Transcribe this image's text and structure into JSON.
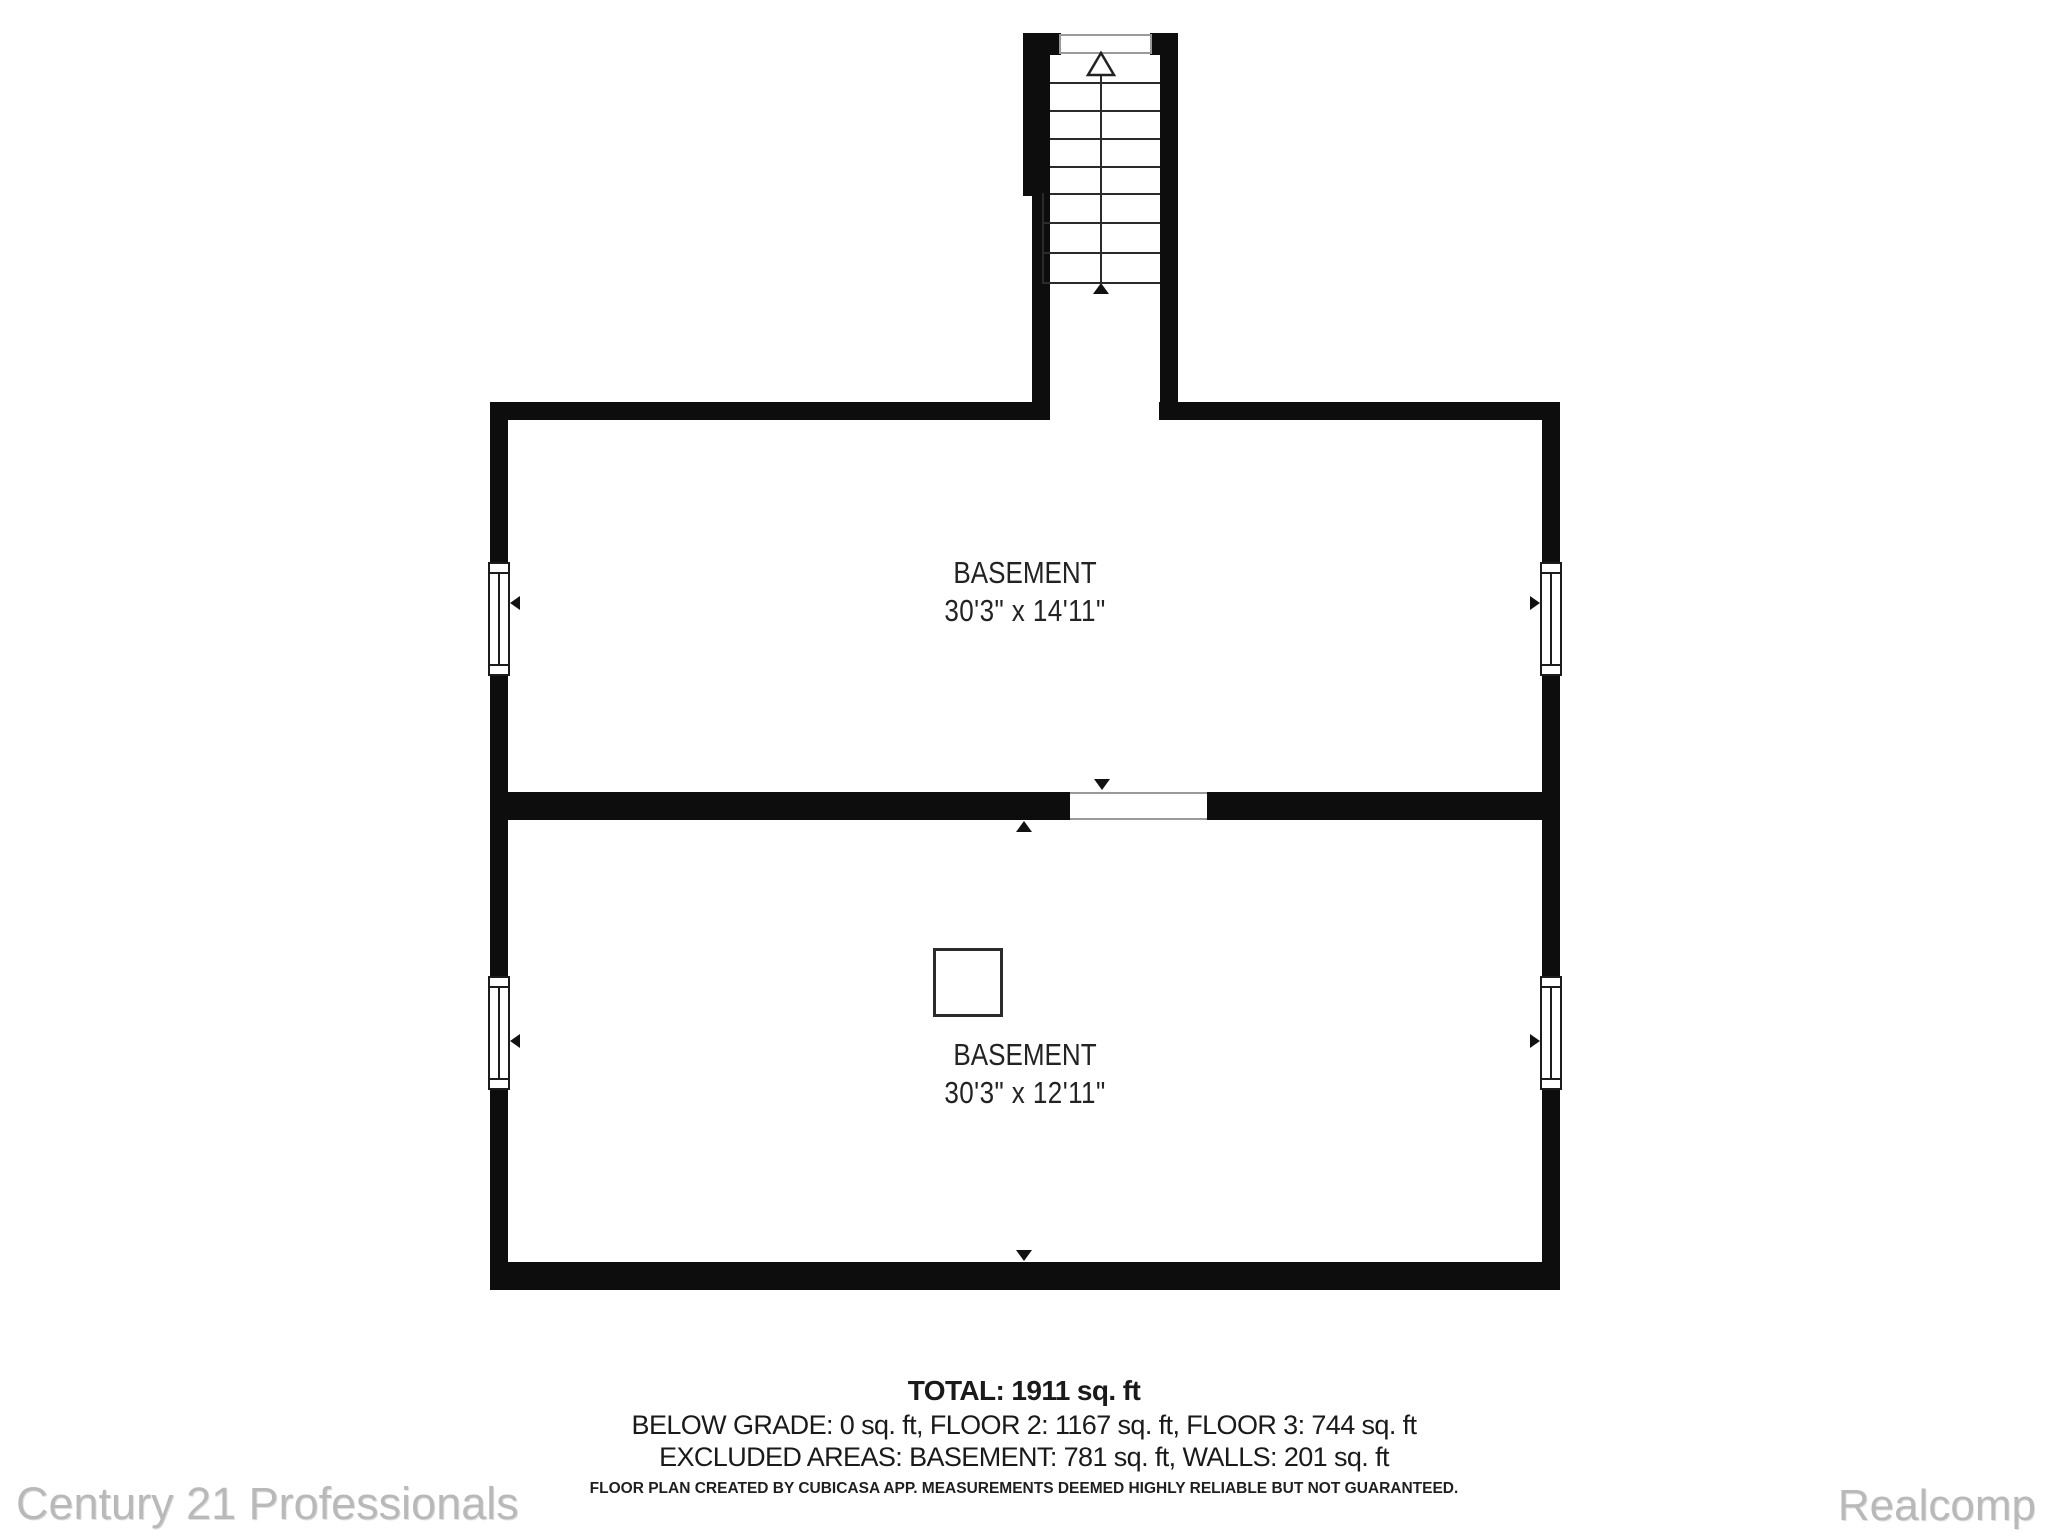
{
  "floor_plan": {
    "floor_name": "BASEMENT",
    "rooms": [
      {
        "name": "BASEMENT",
        "dimensions": "30'3\" x 14'11\""
      },
      {
        "name": "BASEMENT",
        "dimensions": "30'3\" x 12'11\""
      }
    ],
    "summary": {
      "total": "TOTAL: 1911 sq. ft",
      "floors": "BELOW GRADE: 0 sq. ft, FLOOR 2: 1167 sq. ft, FLOOR 3: 744 sq. ft",
      "excluded": "EXCLUDED AREAS: BASEMENT: 781 sq. ft, WALLS: 201 sq. ft"
    },
    "disclaimer": "FLOOR PLAN CREATED BY CUBICASA APP. MEASUREMENTS DEEMED HIGHLY RELIABLE BUT NOT GUARANTEED.",
    "watermarks": {
      "left": "Century 21 Professionals",
      "right": "Realcomp"
    },
    "colors": {
      "wall": "#0d0d0d",
      "label_text": "#232323",
      "summary_text": "#1a1a1a",
      "watermark": "#b9b9b9"
    }
  }
}
